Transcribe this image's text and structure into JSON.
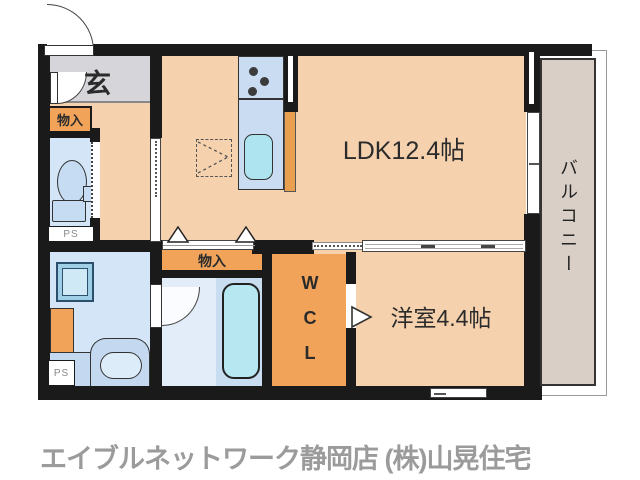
{
  "plan": {
    "rooms": {
      "entrance_label": "玄",
      "ldk_label": "LDK12.4帖",
      "western_room_label": "洋室4.4帖",
      "wcl_label": "W\nC\nL",
      "balcony_label": "バルコニー",
      "storage_upper_label": "物入",
      "storage_lower_label": "物入",
      "ps_upper_label": "PS",
      "ps_lower_label": "PS"
    },
    "colors": {
      "floor": "#f5d1ad",
      "entrance_floor": "#d6d6da",
      "storage_orange": "#f0a359",
      "wet_room_floor": "#d3e5f6",
      "bath_platform": "#c9ddf1",
      "bathtub": "#b7e8f2",
      "kitchen_counter": "#c9dcf1",
      "kitchen_sink": "#ade4ef",
      "balcony": "#d9cfc7",
      "wall": "#1a1a1a"
    }
  },
  "footer": {
    "caption": "エイブルネットワーク静岡店 (株)山晃住宅"
  }
}
